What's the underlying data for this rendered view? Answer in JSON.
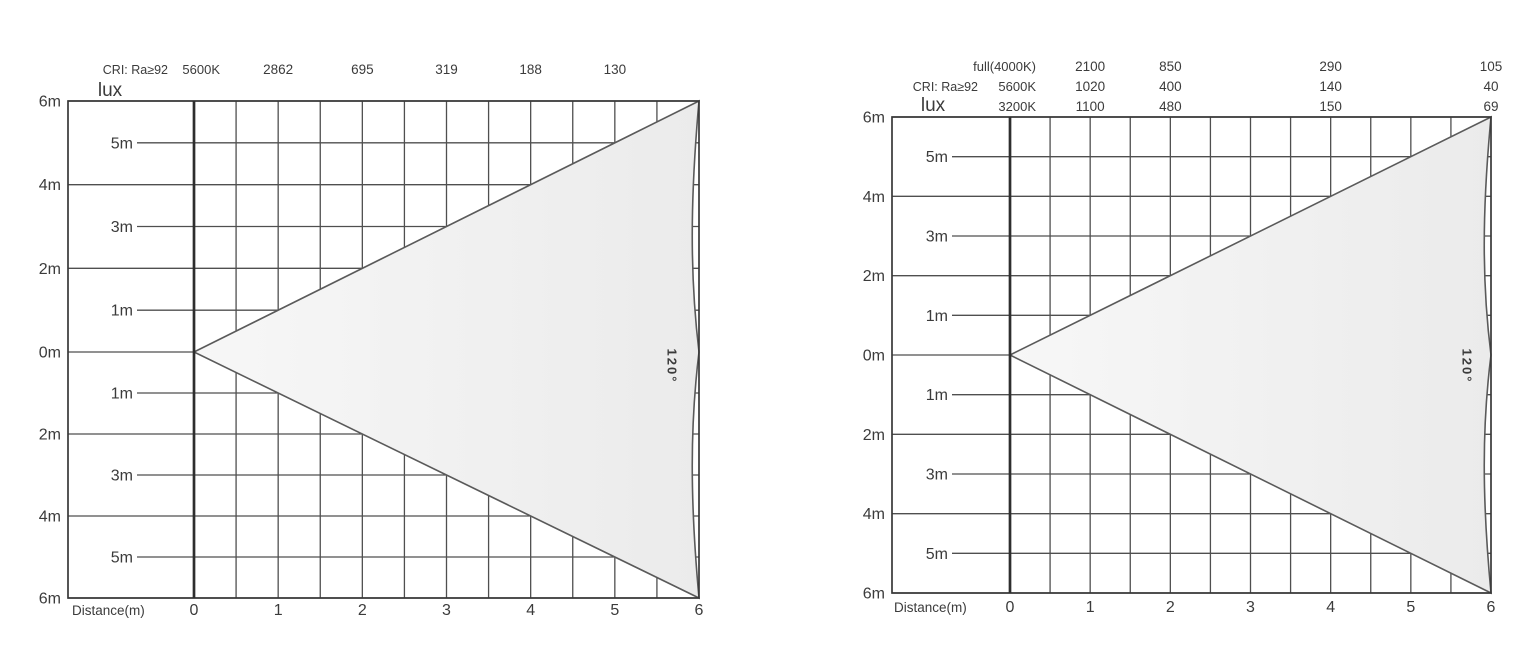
{
  "page_background": "#ffffff",
  "colors": {
    "grid_line": "#4f4f4f",
    "frame": "#383838",
    "axis": "#2e2e2e",
    "cone_outline": "#5a5a5a",
    "cone_fill_start": "#f7f7f7",
    "cone_fill_end": "#ebebeb",
    "text": "#3b3b3b"
  },
  "chart_data": [
    {
      "type": "area",
      "subject": "photometric-beam-spread-cone",
      "beam_angle_label": "120°",
      "xlabel": "Distance(m)",
      "x_ticks": [
        "0",
        "1",
        "2",
        "3",
        "4",
        "5",
        "6"
      ],
      "x_range_m": [
        0,
        6
      ],
      "y_range_m": [
        -6,
        6
      ],
      "grid": true,
      "y_ticks_outer": [
        "6m",
        "4m",
        "2m",
        "0m",
        "2m",
        "4m",
        "6m"
      ],
      "y_ticks_inner": [
        "5m",
        "3m",
        "1m",
        "1m",
        "3m",
        "5m"
      ],
      "header": {
        "cri_label": "CRI: Ra≥92",
        "unit_label": "lux",
        "rows": [
          {
            "temp": "5600K",
            "illuminance_by_distance": [
              {
                "distance_m": 1,
                "lux": "2862"
              },
              {
                "distance_m": 2,
                "lux": "695"
              },
              {
                "distance_m": 3,
                "lux": "319"
              },
              {
                "distance_m": 4,
                "lux": "188"
              },
              {
                "distance_m": 5,
                "lux": "130"
              }
            ]
          }
        ]
      }
    },
    {
      "type": "area",
      "subject": "photometric-beam-spread-cone",
      "beam_angle_label": "120°",
      "xlabel": "Distance(m)",
      "x_ticks": [
        "0",
        "1",
        "2",
        "3",
        "4",
        "5",
        "6"
      ],
      "x_range_m": [
        0,
        6
      ],
      "y_range_m": [
        -6,
        6
      ],
      "grid": true,
      "y_ticks_outer": [
        "6m",
        "4m",
        "2m",
        "0m",
        "2m",
        "4m",
        "6m"
      ],
      "y_ticks_inner": [
        "5m",
        "3m",
        "1m",
        "1m",
        "3m",
        "5m"
      ],
      "header": {
        "cri_label": "CRI: Ra≥92",
        "unit_label": "lux",
        "rows": [
          {
            "temp": "full(4000K)",
            "illuminance_by_distance": [
              {
                "distance_m": 1,
                "lux": "2100"
              },
              {
                "distance_m": 2,
                "lux": "850"
              },
              {
                "distance_m": 4,
                "lux": "290"
              },
              {
                "distance_m": 6,
                "lux": "105"
              }
            ]
          },
          {
            "temp": "5600K",
            "illuminance_by_distance": [
              {
                "distance_m": 1,
                "lux": "1020"
              },
              {
                "distance_m": 2,
                "lux": "400"
              },
              {
                "distance_m": 4,
                "lux": "140"
              },
              {
                "distance_m": 6,
                "lux": "40"
              }
            ]
          },
          {
            "temp": "3200K",
            "illuminance_by_distance": [
              {
                "distance_m": 1,
                "lux": "1100"
              },
              {
                "distance_m": 2,
                "lux": "480"
              },
              {
                "distance_m": 4,
                "lux": "150"
              },
              {
                "distance_m": 6,
                "lux": "69"
              }
            ]
          }
        ]
      }
    }
  ]
}
